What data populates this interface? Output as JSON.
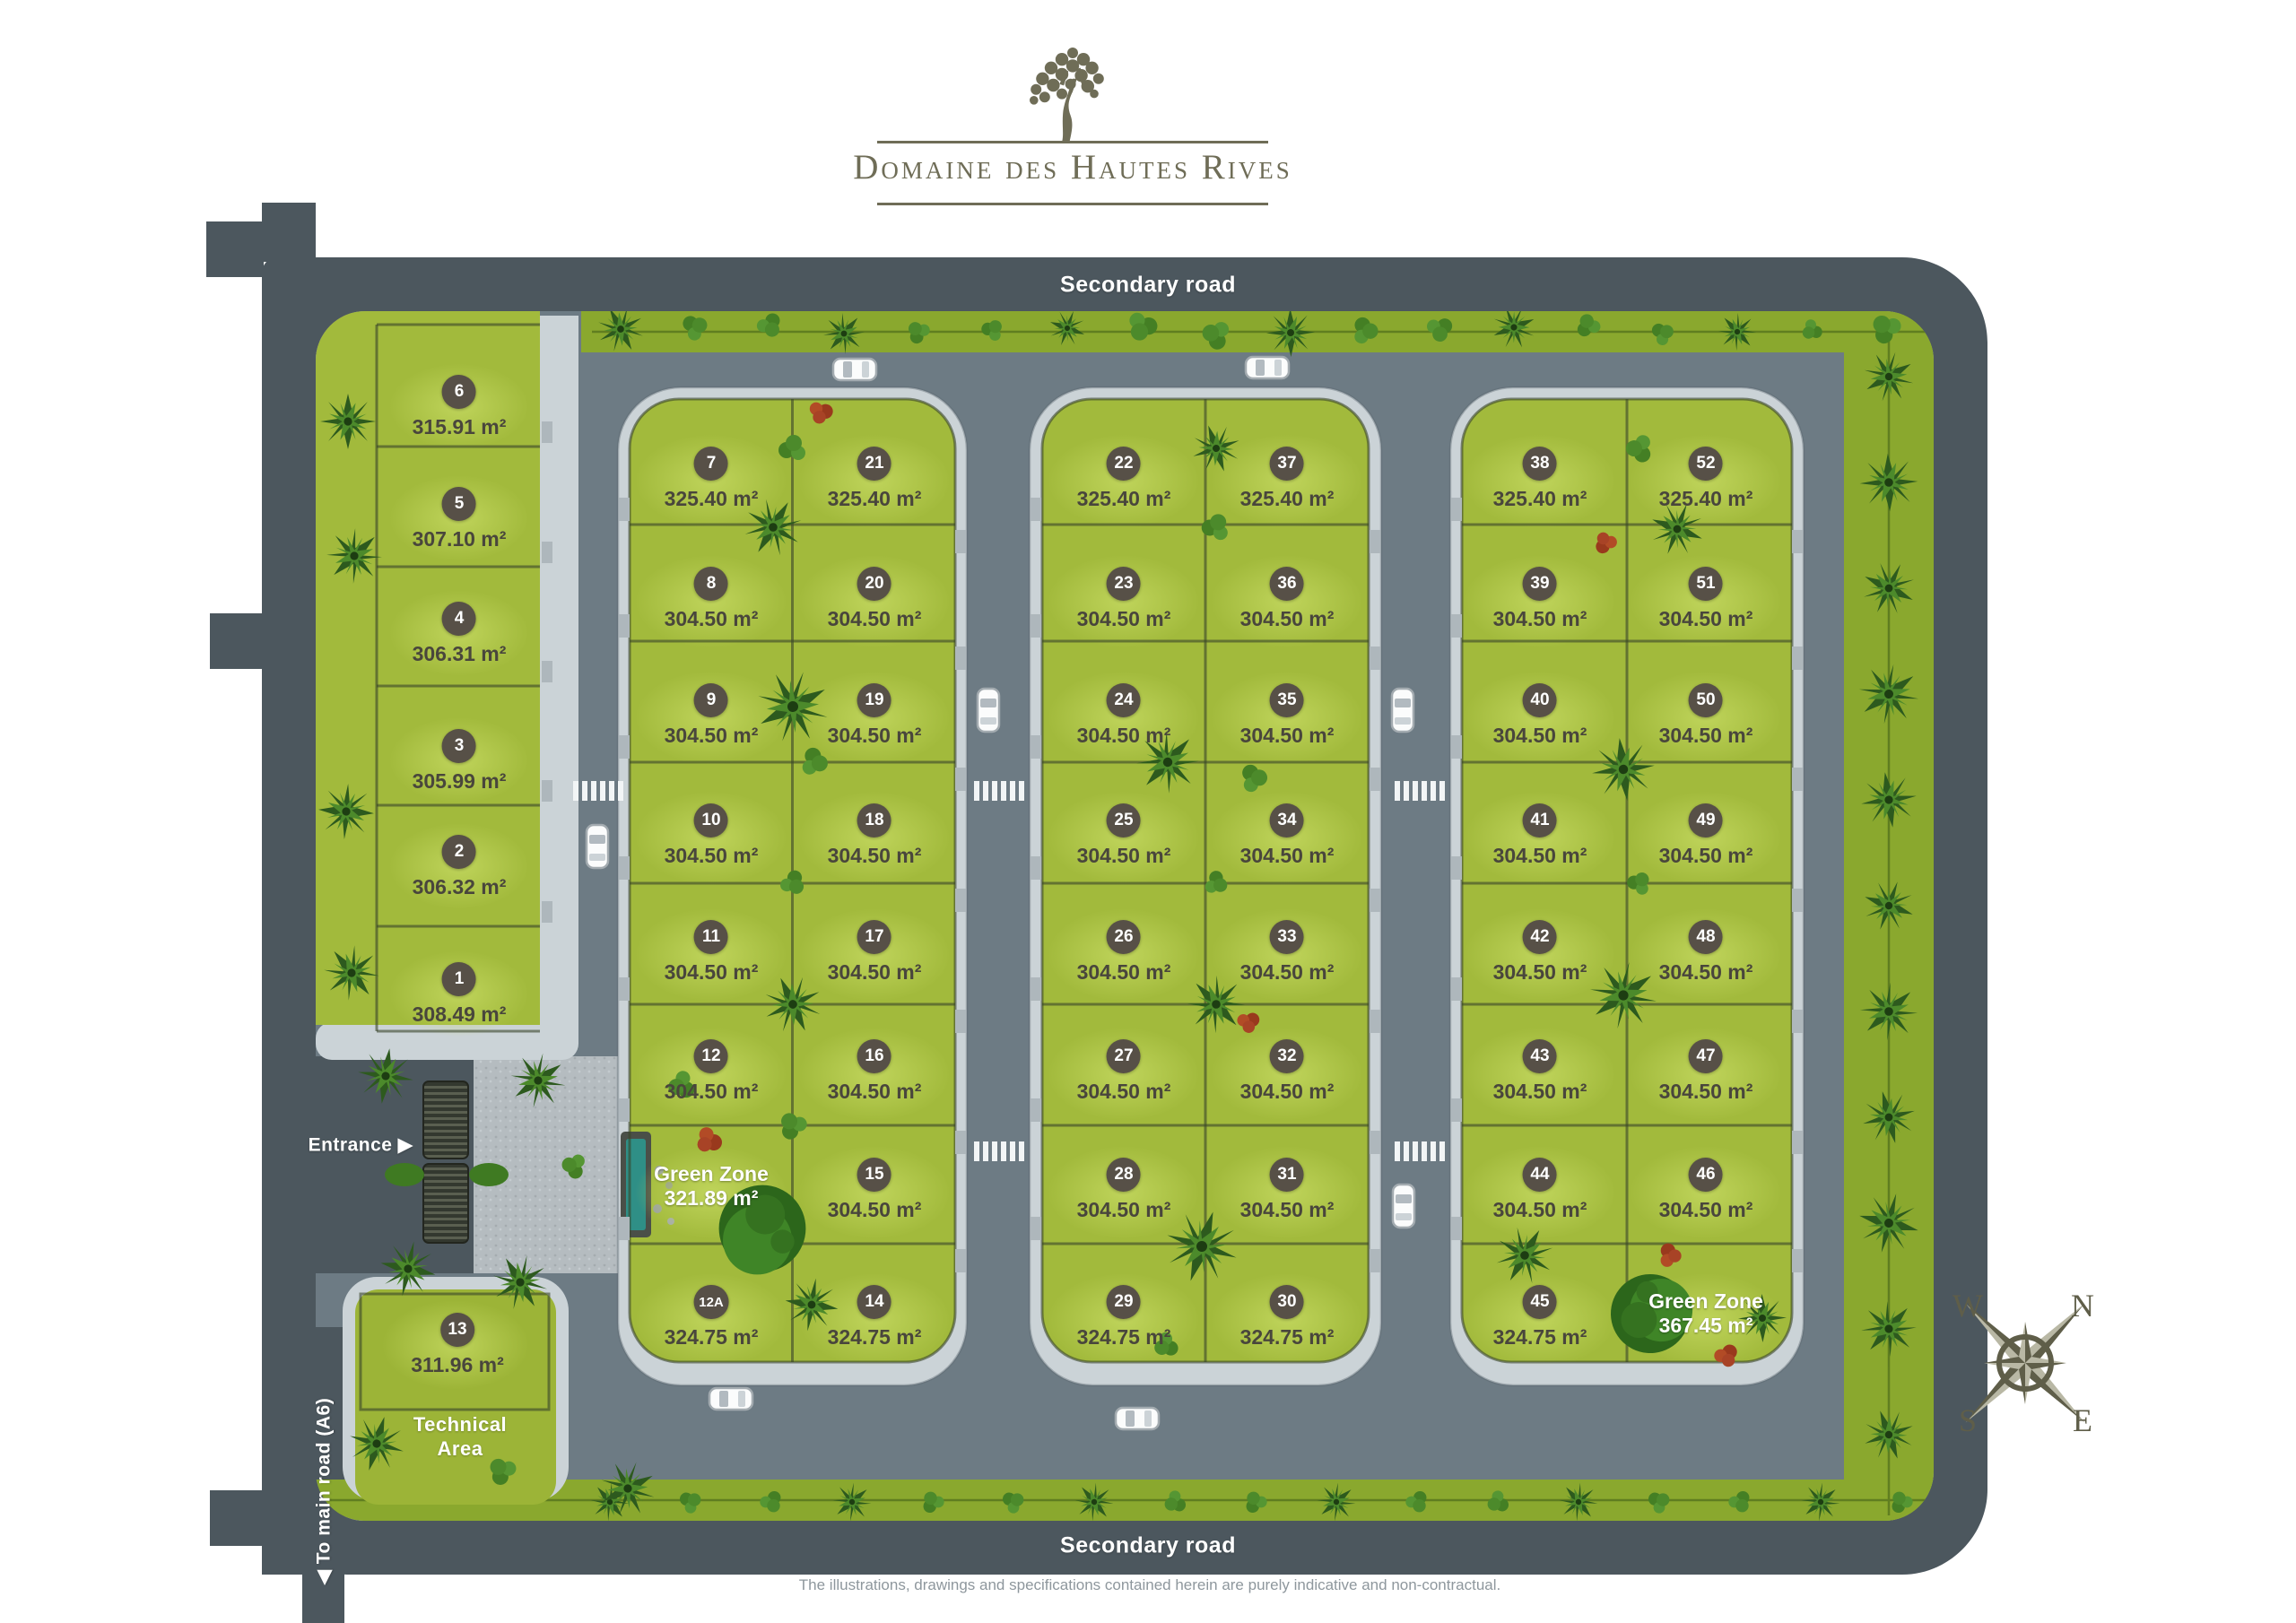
{
  "logo": {
    "title": "Domaine des Hautes Rives",
    "icon": "tree-icon"
  },
  "roads": {
    "secondary_top": "Secondary road",
    "secondary_bottom": "Secondary road",
    "entrance": "Entrance",
    "entrance_arrow": "▶",
    "to_main": "To main road (A6)",
    "to_main_arrow": "◀"
  },
  "labels": {
    "technical_line1": "Technical",
    "technical_line2": "Area"
  },
  "compass": {
    "n": "N",
    "e": "E",
    "s": "S",
    "w": "W"
  },
  "disclaimer": "The illustrations, drawings and specifications contained herein are purely indicative and non-contractual.",
  "colors": {
    "road_outer": "#4c575e",
    "road_inner": "#6d7b84",
    "sidewalk": "#cbd3d7",
    "lot_green": "#a2ba3c",
    "strip_green": "#8aa82e",
    "badge": "#575047",
    "area_text": "#49463c",
    "logo_olive": "#6f6d57",
    "pool_teal": "#2f8f86"
  },
  "left_column": [
    {
      "num": "6",
      "area": "315.91 m²"
    },
    {
      "num": "5",
      "area": "307.10 m²"
    },
    {
      "num": "4",
      "area": "306.31 m²"
    },
    {
      "num": "3",
      "area": "305.99 m²"
    },
    {
      "num": "2",
      "area": "306.32 m²"
    },
    {
      "num": "1",
      "area": "308.49 m²"
    }
  ],
  "lot_13": {
    "num": "13",
    "area": "311.96 m²"
  },
  "blocks": [
    {
      "id": "block-west",
      "rows": [
        [
          {
            "num": "7",
            "area": "325.40 m²"
          },
          {
            "num": "21",
            "area": "325.40 m²"
          }
        ],
        [
          {
            "num": "8",
            "area": "304.50 m²"
          },
          {
            "num": "20",
            "area": "304.50 m²"
          }
        ],
        [
          {
            "num": "9",
            "area": "304.50 m²"
          },
          {
            "num": "19",
            "area": "304.50 m²"
          }
        ],
        [
          {
            "num": "10",
            "area": "304.50 m²"
          },
          {
            "num": "18",
            "area": "304.50 m²"
          }
        ],
        [
          {
            "num": "11",
            "area": "304.50 m²"
          },
          {
            "num": "17",
            "area": "304.50 m²"
          }
        ],
        [
          {
            "num": "12",
            "area": "304.50 m²"
          },
          {
            "num": "16",
            "area": "304.50 m²"
          }
        ],
        [
          {
            "green": true,
            "label": "Green Zone",
            "area": "321.89 m²"
          },
          {
            "num": "15",
            "area": "304.50 m²"
          }
        ],
        [
          {
            "num": "12A",
            "area": "324.75 m²"
          },
          {
            "num": "14",
            "area": "324.75 m²"
          }
        ]
      ]
    },
    {
      "id": "block-center",
      "rows": [
        [
          {
            "num": "22",
            "area": "325.40 m²"
          },
          {
            "num": "37",
            "area": "325.40 m²"
          }
        ],
        [
          {
            "num": "23",
            "area": "304.50 m²"
          },
          {
            "num": "36",
            "area": "304.50 m²"
          }
        ],
        [
          {
            "num": "24",
            "area": "304.50 m²"
          },
          {
            "num": "35",
            "area": "304.50 m²"
          }
        ],
        [
          {
            "num": "25",
            "area": "304.50 m²"
          },
          {
            "num": "34",
            "area": "304.50 m²"
          }
        ],
        [
          {
            "num": "26",
            "area": "304.50 m²"
          },
          {
            "num": "33",
            "area": "304.50 m²"
          }
        ],
        [
          {
            "num": "27",
            "area": "304.50 m²"
          },
          {
            "num": "32",
            "area": "304.50 m²"
          }
        ],
        [
          {
            "num": "28",
            "area": "304.50 m²"
          },
          {
            "num": "31",
            "area": "304.50 m²"
          }
        ],
        [
          {
            "num": "29",
            "area": "324.75 m²"
          },
          {
            "num": "30",
            "area": "324.75 m²"
          }
        ]
      ]
    },
    {
      "id": "block-east",
      "rows": [
        [
          {
            "num": "38",
            "area": "325.40 m²"
          },
          {
            "num": "52",
            "area": "325.40 m²"
          }
        ],
        [
          {
            "num": "39",
            "area": "304.50 m²"
          },
          {
            "num": "51",
            "area": "304.50 m²"
          }
        ],
        [
          {
            "num": "40",
            "area": "304.50 m²"
          },
          {
            "num": "50",
            "area": "304.50 m²"
          }
        ],
        [
          {
            "num": "41",
            "area": "304.50 m²"
          },
          {
            "num": "49",
            "area": "304.50 m²"
          }
        ],
        [
          {
            "num": "42",
            "area": "304.50 m²"
          },
          {
            "num": "48",
            "area": "304.50 m²"
          }
        ],
        [
          {
            "num": "43",
            "area": "304.50 m²"
          },
          {
            "num": "47",
            "area": "304.50 m²"
          }
        ],
        [
          {
            "num": "44",
            "area": "304.50 m²"
          },
          {
            "num": "46",
            "area": "304.50 m²"
          }
        ],
        [
          {
            "num": "45",
            "area": "324.75 m²"
          },
          {
            "green": true,
            "label": "Green Zone",
            "area": "367.45 m²"
          }
        ]
      ]
    }
  ]
}
